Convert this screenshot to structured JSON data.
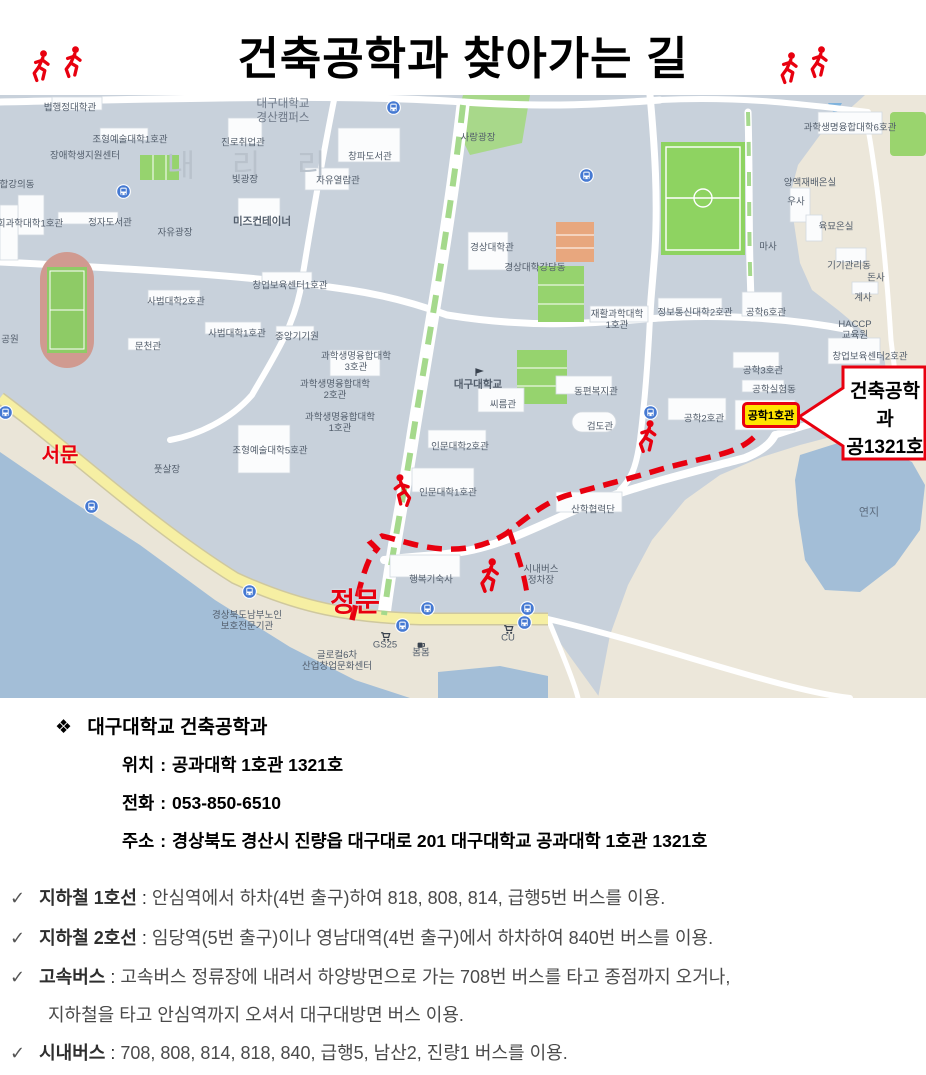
{
  "title": "건축공학과 찾아가는 길",
  "map": {
    "campus_line1": "대구대학교",
    "campus_line2": "경산캠퍼스",
    "area_faint": "내 리 리",
    "gates": {
      "west": "서문",
      "main": "정문"
    },
    "highlight": "공학1호관",
    "callout": {
      "line1": "건축공학과",
      "line2": "공1321호"
    },
    "labels": [
      {
        "t": "법행정대학관",
        "x": 70,
        "y": 13
      },
      {
        "t": "조형예술대학1호관",
        "x": 130,
        "y": 45
      },
      {
        "t": "장애학생지원센터",
        "x": 85,
        "y": 61
      },
      {
        "t": "합강의동",
        "x": 17,
        "y": 90
      },
      {
        "t": "회과학대학1호관",
        "x": 30,
        "y": 129
      },
      {
        "t": "정자도서관",
        "x": 110,
        "y": 128
      },
      {
        "t": "자유광장",
        "x": 175,
        "y": 138
      },
      {
        "t": "공원",
        "x": 10,
        "y": 245
      },
      {
        "t": "진로취업관",
        "x": 243,
        "y": 48
      },
      {
        "t": "빛광장",
        "x": 245,
        "y": 85
      },
      {
        "t": "미즈컨테이너",
        "x": 262,
        "y": 127,
        "s": 10.5,
        "w": 600
      },
      {
        "t": "창파도서관",
        "x": 370,
        "y": 62
      },
      {
        "t": "자유열람관",
        "x": 338,
        "y": 86
      },
      {
        "t": "사랑광장",
        "x": 478,
        "y": 43
      },
      {
        "t": "창업보육센터1호관",
        "x": 290,
        "y": 191
      },
      {
        "t": "사범대학2호관",
        "x": 176,
        "y": 207
      },
      {
        "t": "사범대학1호관",
        "x": 237,
        "y": 239
      },
      {
        "t": "문천관",
        "x": 148,
        "y": 252
      },
      {
        "t": "중앙기기원",
        "x": 297,
        "y": 242
      },
      {
        "t": "과학생명융합대학",
        "l2": "3호관",
        "x": 356,
        "y": 267
      },
      {
        "t": "과학생명융합대학",
        "l2": "2호관",
        "x": 335,
        "y": 295
      },
      {
        "t": "과학생명융합대학",
        "l2": "1호관",
        "x": 340,
        "y": 328
      },
      {
        "t": "경상대학관",
        "x": 492,
        "y": 153
      },
      {
        "t": "경상대학강당동",
        "x": 535,
        "y": 173
      },
      {
        "t": "재활과학대학",
        "l2": "1호관",
        "x": 617,
        "y": 225
      },
      {
        "t": "정보통신대학2호관",
        "x": 695,
        "y": 218
      },
      {
        "t": "공학6호관",
        "x": 766,
        "y": 218
      },
      {
        "t": "과학생명융합대학6호관",
        "x": 850,
        "y": 33
      },
      {
        "t": "양액재배온실",
        "x": 810,
        "y": 88
      },
      {
        "t": "우사",
        "x": 796,
        "y": 107
      },
      {
        "t": "육묘온실",
        "x": 836,
        "y": 132
      },
      {
        "t": "마사",
        "x": 768,
        "y": 152
      },
      {
        "t": "기기관리동",
        "x": 849,
        "y": 171
      },
      {
        "t": "돈사",
        "x": 876,
        "y": 183
      },
      {
        "t": "계사",
        "x": 863,
        "y": 203
      },
      {
        "t": "HACCP",
        "l2": "교육원",
        "x": 855,
        "y": 235
      },
      {
        "t": "창업보육센터2호관",
        "x": 870,
        "y": 262
      },
      {
        "t": "공학3호관",
        "x": 763,
        "y": 276
      },
      {
        "t": "공학실험동",
        "x": 774,
        "y": 295
      },
      {
        "t": "공학2호관",
        "x": 704,
        "y": 324
      },
      {
        "t": "동편복지관",
        "x": 596,
        "y": 297
      },
      {
        "t": "씨름관",
        "x": 503,
        "y": 310
      },
      {
        "t": "검도관",
        "x": 600,
        "y": 332
      },
      {
        "t": "대구대학교",
        "x": 478,
        "y": 290,
        "s": 10.5,
        "w": 600
      },
      {
        "t": "인문대학2호관",
        "x": 460,
        "y": 352
      },
      {
        "t": "인문대학1호관",
        "x": 448,
        "y": 398
      },
      {
        "t": "산학협력단",
        "x": 593,
        "y": 415
      },
      {
        "t": "시내버스",
        "l2": "정차장",
        "x": 541,
        "y": 480
      },
      {
        "t": "행복기숙사",
        "x": 431,
        "y": 485
      },
      {
        "t": "조형예술대학5호관",
        "x": 270,
        "y": 356
      },
      {
        "t": "풋살장",
        "x": 167,
        "y": 375
      },
      {
        "t": "경상북도남부노인",
        "l2": "보호전문기관",
        "x": 247,
        "y": 526
      },
      {
        "t": "GS25",
        "x": 385,
        "y": 550
      },
      {
        "t": "봄봄",
        "x": 421,
        "y": 558
      },
      {
        "t": "CU",
        "x": 508,
        "y": 543
      },
      {
        "t": "글로컬6차",
        "l2": "산업창업문화센터",
        "x": 337,
        "y": 566
      },
      {
        "t": "연지",
        "x": 869,
        "y": 418,
        "s": 11,
        "c": "#5c6b7d"
      }
    ]
  },
  "info": {
    "bullet": "❖",
    "heading": "대구대학교  건축공학과",
    "sep": ":",
    "rows": [
      {
        "label": "위치",
        "value": "공과대학 1호관 1321호"
      },
      {
        "label": "전화",
        "value": "053-850-6510"
      },
      {
        "label": "주소",
        "value": "경상북도 경산시 진량읍 대구대로 201 대구대학교 공과대학 1호관 1321호"
      }
    ]
  },
  "transit": {
    "check": "✓",
    "sep": ":",
    "items": [
      {
        "term": "지하철 1호선",
        "desc": "안심역에서 하차(4번 출구)하여 818, 808, 814, 급행5번 버스를 이용."
      },
      {
        "term": "지하철 2호선",
        "desc": "임당역(5번 출구)이나 영남대역(4번 출구)에서 하차하여 840번 버스를 이용."
      },
      {
        "term": "고속버스",
        "desc": "고속버스 정류장에 내려서 하양방면으로 가는 708번 버스를 타고 종점까지 오거나,",
        "cont": "지하철을 타고 안심역까지 오셔서 대구대방면 버스 이용."
      },
      {
        "term": "시내버스",
        "desc": "708, 808, 814, 818, 840, 급행5, 남산2, 진량1 버스를 이용."
      }
    ]
  },
  "colors": {
    "accent_red": "#e8000f",
    "highlight_yellow": "#ffe400",
    "map_bg": "#c8d1db",
    "terrain_sand": "#ece7da",
    "water": "#a3bed7",
    "road_yellow": "#f6efa3",
    "field_green": "#8ed361"
  }
}
